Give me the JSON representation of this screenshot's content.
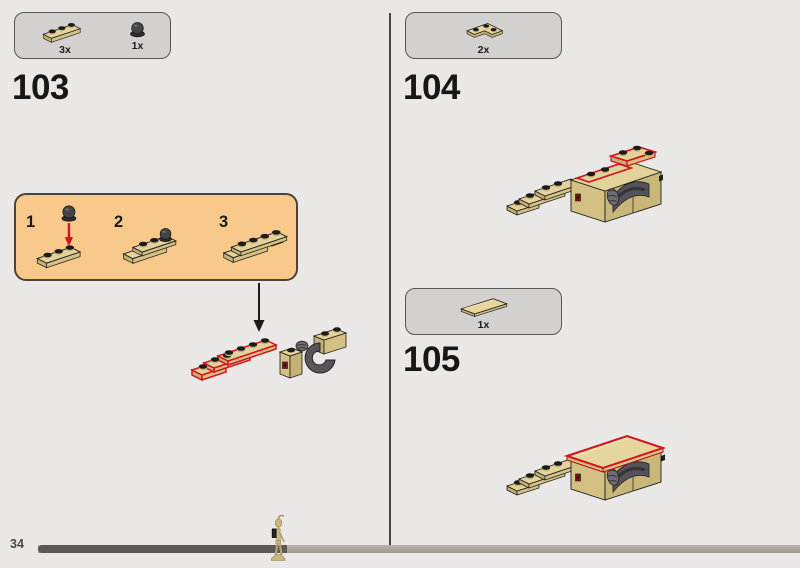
{
  "footer": {
    "page_number": "34",
    "progress_fraction": 0.33
  },
  "colors": {
    "background": "#e9e8e6",
    "parts_box_fill": "#d2d1d0",
    "parts_box_border": "#55565a",
    "callout_fill": "#f9c98c",
    "callout_border": "#4e4337",
    "brick_tan": "#d8c68e",
    "new_part_outline_red": "#d5121e",
    "grey_piece": "#57555a",
    "progress_done": "#5b5855",
    "progress_remaining": "#aba49d"
  },
  "steps": {
    "s103": {
      "number": "103",
      "parts": [
        {
          "icon": "plate-1x3-tan-icon",
          "count": "3x"
        },
        {
          "icon": "dark-round-stud-icon",
          "count": "1x"
        }
      ],
      "callout": {
        "substeps": [
          {
            "label": "1"
          },
          {
            "label": "2"
          },
          {
            "label": "3"
          }
        ]
      }
    },
    "s104": {
      "number": "104",
      "parts": [
        {
          "icon": "corner-plate-2x2-tan-icon",
          "count": "2x"
        }
      ]
    },
    "s105": {
      "number": "105",
      "parts": [
        {
          "icon": "tile-2x4-tan-icon",
          "count": "1x"
        }
      ]
    }
  }
}
